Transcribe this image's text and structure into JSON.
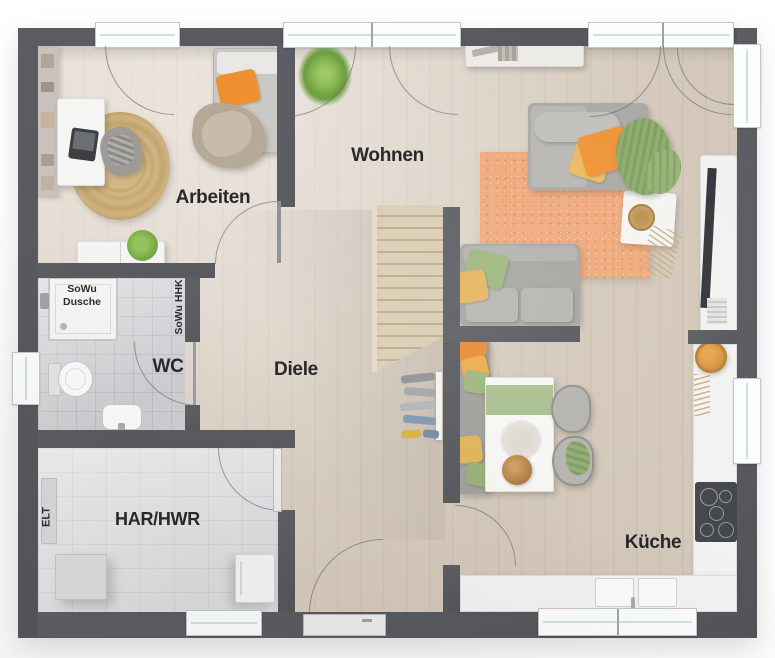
{
  "plan": {
    "title": "Grundriss Erdgeschoss",
    "rooms": [
      {
        "id": "arbeiten",
        "label": "Arbeiten"
      },
      {
        "id": "wohnen",
        "label": "Wohnen"
      },
      {
        "id": "wc",
        "label": "WC"
      },
      {
        "id": "diele",
        "label": "Diele"
      },
      {
        "id": "har_hwr",
        "label": "HAR/HWR"
      },
      {
        "id": "kueche",
        "label": "Küche"
      }
    ],
    "annotations": [
      {
        "id": "sowu_dusche",
        "line1": "SoWu",
        "line2": "Dusche"
      },
      {
        "id": "sowu_hhk",
        "label": "SoWu HHK"
      },
      {
        "id": "elt",
        "label": "ELT"
      }
    ],
    "colors": {
      "wall": "#55575c",
      "wood_floor": "#dcd1c3",
      "tile_floor": "#d8dadc",
      "utility_floor": "#e5e6e8",
      "rug_salmon": "#efa87a",
      "rug_jute": "#cfb183",
      "accent_orange": "#ee9232",
      "accent_yellow": "#e9b95e",
      "accent_green": "#9cb67c",
      "counter_white": "#f2f3f1"
    }
  }
}
